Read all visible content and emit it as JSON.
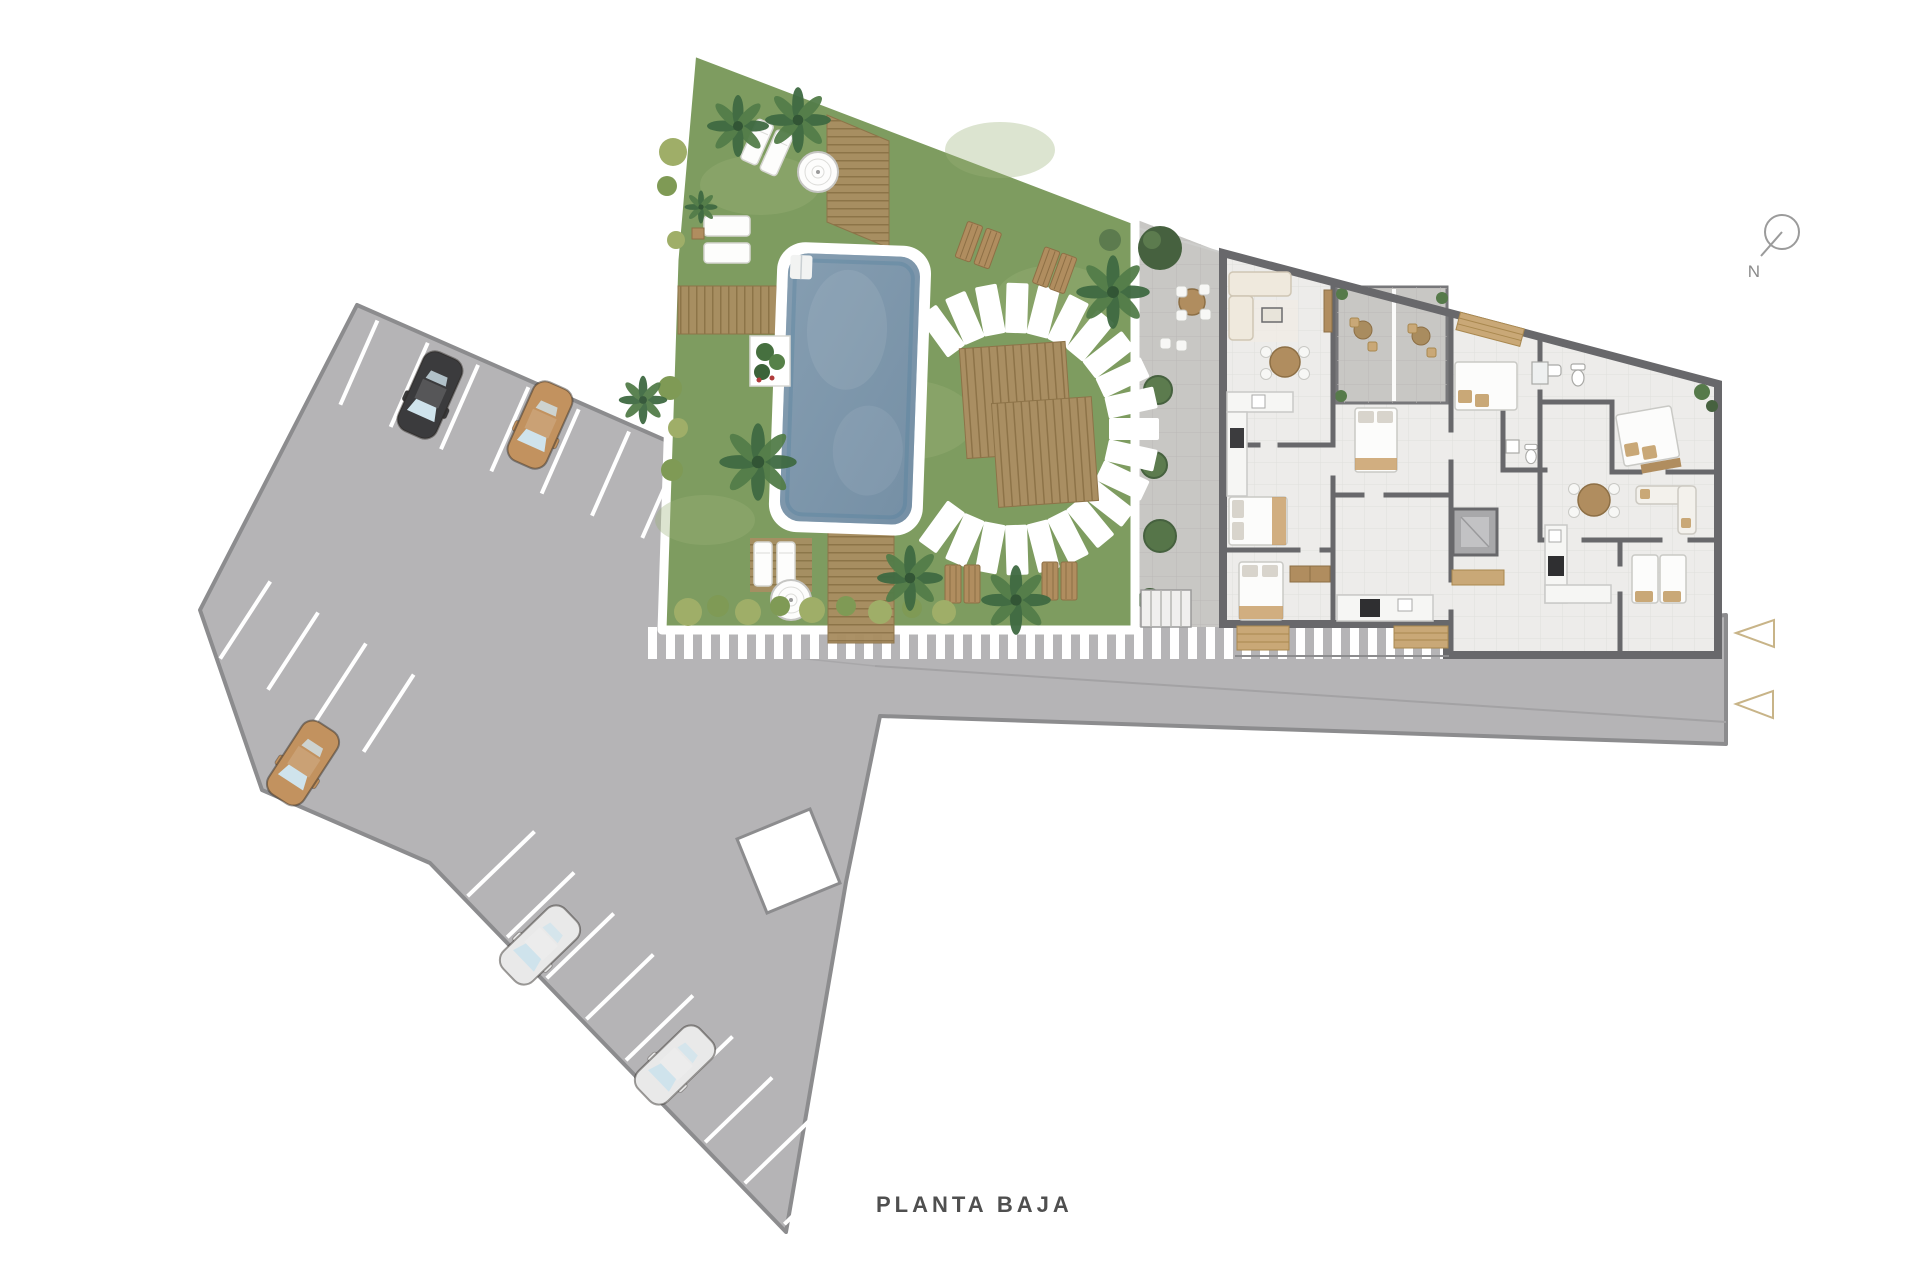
{
  "plan": {
    "title": "PLANTA BAJA",
    "compass_label": "N"
  },
  "areas": {
    "parking": "parking-lot",
    "garden": "pool-garden",
    "building": "apartment-block",
    "road": "access-road",
    "sidewalk": "striped-sidewalk",
    "walkway": "terrace-walkway"
  },
  "colors": {
    "asphalt": "#b5b4b6",
    "asphalt_border": "#8c8c8e",
    "lawn": "#7e9c60",
    "pool_water": "#7f97ab",
    "deck": "#a98e62",
    "building_floor": "#edecea",
    "terrace": "#c8c7c4",
    "wall": "#68686b",
    "accent_tan": "#c8b488",
    "title_text": "#4f4f4f",
    "compass": "#9b9b9b"
  },
  "cars": [
    {
      "name": "car-black",
      "hex": "#3b3b3d"
    },
    {
      "name": "car-tan",
      "hex": "#c2925f"
    },
    {
      "name": "car-tan-2",
      "hex": "#c2925f"
    },
    {
      "name": "car-white",
      "hex": "#e9e9e9"
    },
    {
      "name": "car-white-2",
      "hex": "#e9e9e9"
    }
  ]
}
